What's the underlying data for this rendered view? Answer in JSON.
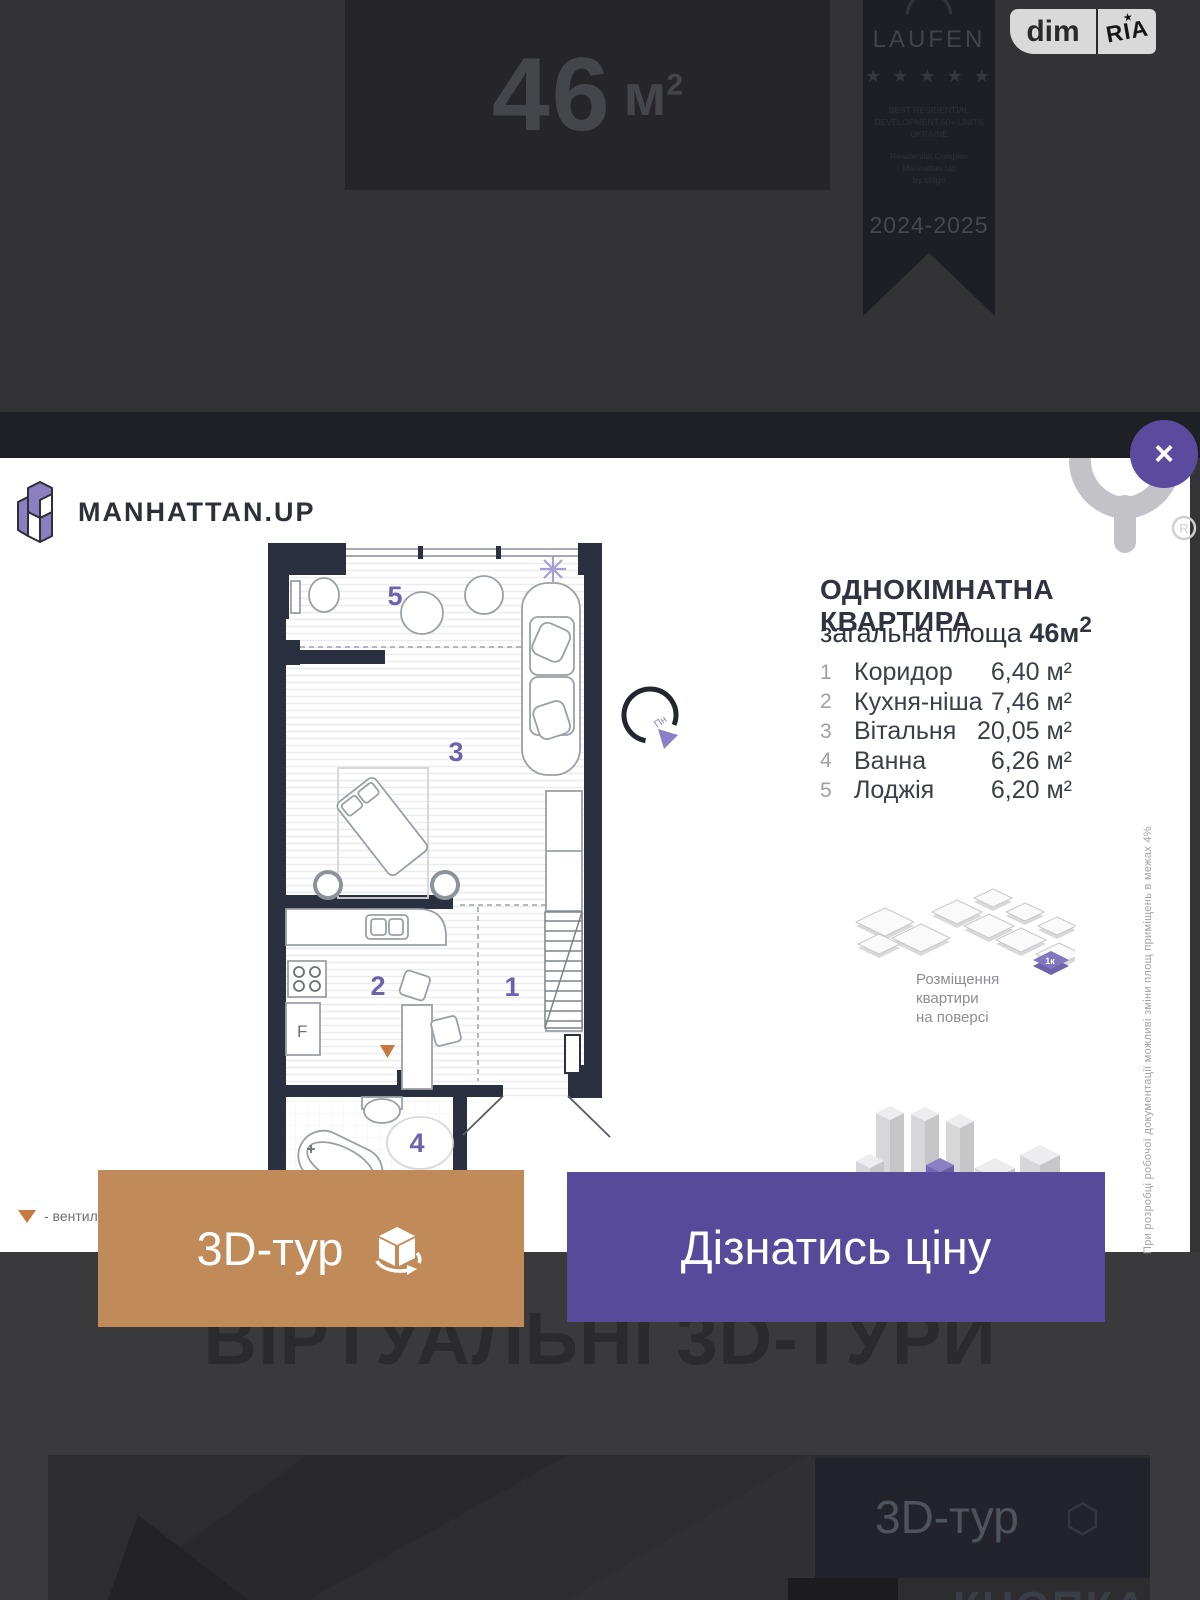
{
  "top": {
    "area_value": "46",
    "area_unit": "м",
    "area_sup": "2",
    "ribbon": {
      "brand": "LAUFEN",
      "stars": "★ ★ ★ ★ ★",
      "award_lines": [
        "BEST RESIDENTIAL",
        "DEVELOPMENT 50+ UNITS",
        "UKRAINE"
      ],
      "project_lines": [
        "Residential Complex",
        "Manhattan Up",
        "by blago"
      ],
      "years": "2024-2025"
    },
    "badge": {
      "left": "dim",
      "right": "RIA",
      "star": "★"
    }
  },
  "card": {
    "logo_text": "MANHATTAN.UP",
    "close_label": "×",
    "registered_mark": "R",
    "title": "ОДНОКІМНАТНА КВАРТИРА",
    "subtitle_prefix": "загальна площа ",
    "subtitle_value": "46м",
    "subtitle_sup": "2",
    "rooms": [
      {
        "num": "1",
        "name": "Коридор",
        "area": "6,40 м²"
      },
      {
        "num": "2",
        "name": "Кухня-ніша",
        "area": "7,46 м²"
      },
      {
        "num": "3",
        "name": "Вітальня",
        "area": "20,05 м²"
      },
      {
        "num": "4",
        "name": "Ванна",
        "area": "6,26 м²"
      },
      {
        "num": "5",
        "name": "Лоджія",
        "area": "6,20 м²"
      }
    ],
    "plan": {
      "corridor": "1",
      "kitchen": "2",
      "living": "3",
      "bath": "4",
      "loggia": "5",
      "fridge": "F",
      "compass": "Пн"
    },
    "floor_note_lines": [
      "Розміщення",
      "квартири",
      "на поверсі"
    ],
    "unit_marker": "1к",
    "side_note": "При розробці робочої документації можливі зміни площ приміщень в межах 4%",
    "legend_text": "- вентиляція"
  },
  "buttons": {
    "tour_label": "3D-тур",
    "price_label": "Дізнатись ціну"
  },
  "bottom": {
    "heading": "ВІРТУАЛЬНІ 3D-ТУРИ",
    "preview_tour": "3D-тур",
    "preview_caption": "КНОПКА"
  },
  "colors": {
    "accent_purple": "#584a9b",
    "button_tan": "#c08a59",
    "plan_number_purple": "#6c63ad",
    "wall_dark": "#2b3040",
    "vent_orange": "#c7793f"
  }
}
